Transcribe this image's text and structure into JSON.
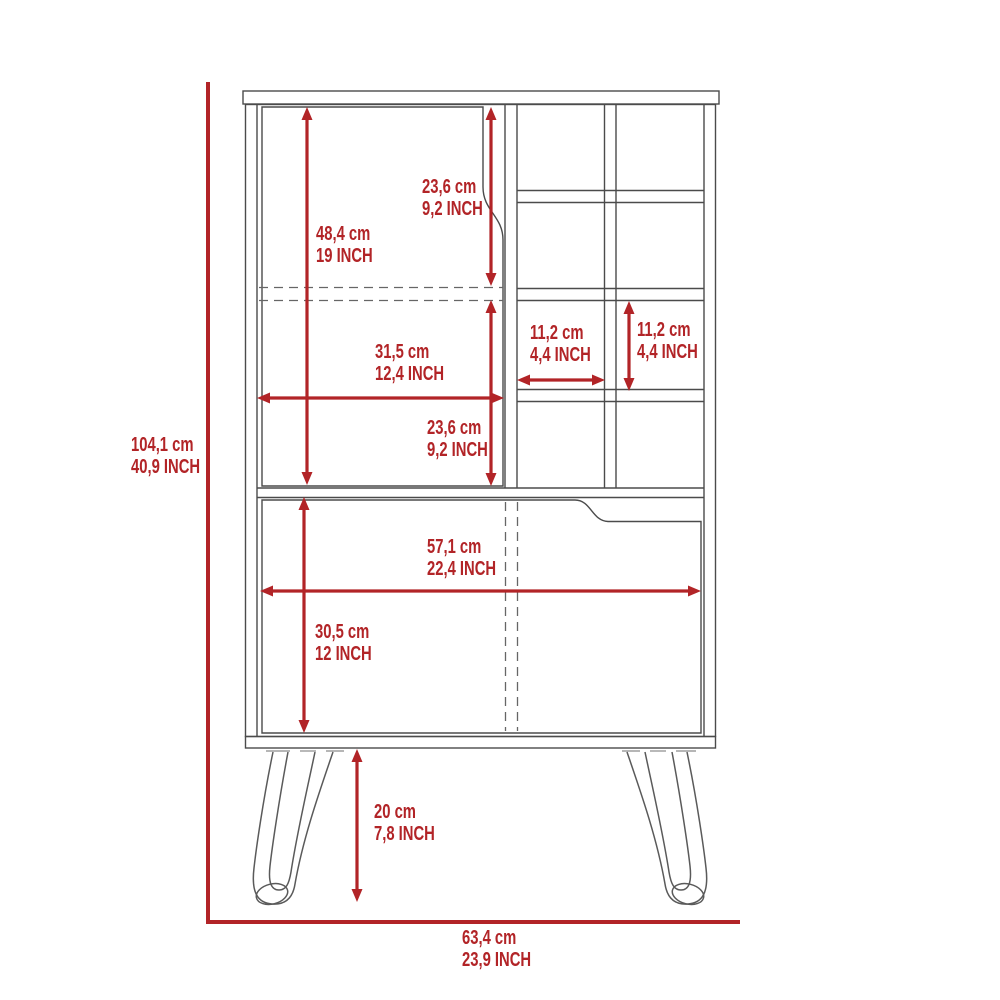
{
  "colors": {
    "dimension_red": "#B22427",
    "outline_gray": "#4B4B4B"
  },
  "dimensions": {
    "overall_height": {
      "cm": "104,1 cm",
      "inch": "40,9 INCH"
    },
    "overall_width": {
      "cm": "63,4 cm",
      "inch": "23,9 INCH"
    },
    "upper_door_height": {
      "cm": "48,4 cm",
      "inch": "19 INCH"
    },
    "upper_compartment_height": {
      "cm": "23,6 cm",
      "inch": "9,2 INCH"
    },
    "lower_compartment_height": {
      "cm": "23,6 cm",
      "inch": "9,2 INCH"
    },
    "upper_door_width": {
      "cm": "31,5 cm",
      "inch": "12,4 INCH"
    },
    "cubby_width": {
      "cm": "11,2 cm",
      "inch": "4,4 INCH"
    },
    "cubby_height": {
      "cm": "11,2 cm",
      "inch": "4,4 INCH"
    },
    "lower_door_width": {
      "cm": "57,1 cm",
      "inch": "22,4 INCH"
    },
    "lower_door_height": {
      "cm": "30,5 cm",
      "inch": "12 INCH"
    },
    "leg_height": {
      "cm": "20 cm",
      "inch": "7,8 INCH"
    }
  }
}
